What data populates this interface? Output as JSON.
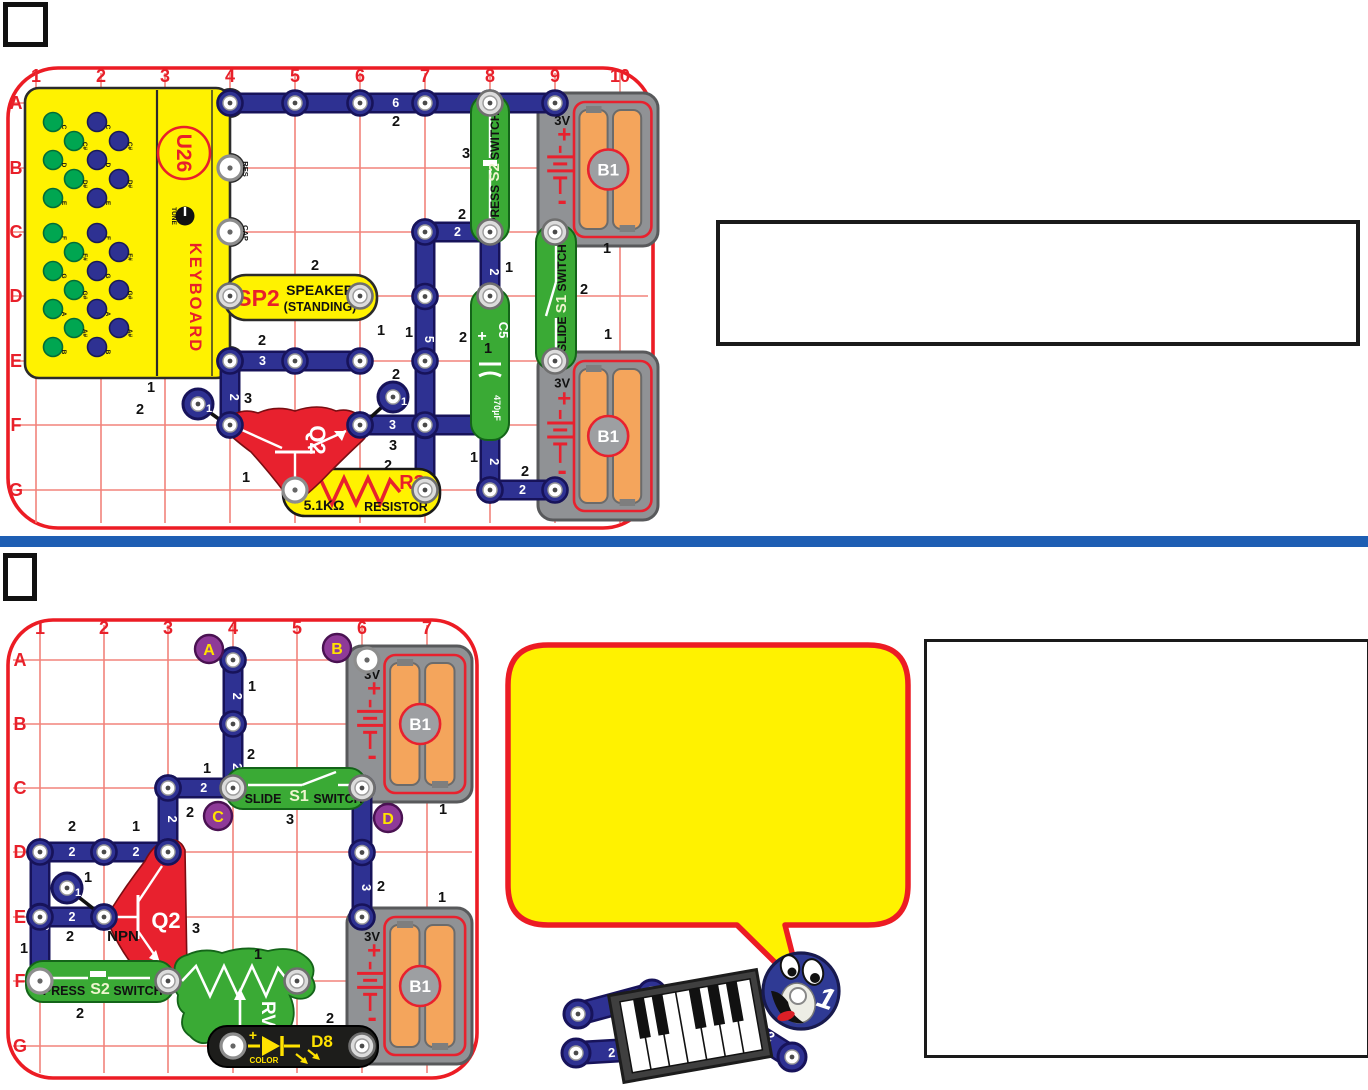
{
  "colors": {
    "board_border": "#EC1C24",
    "grid": "#F2837B",
    "grid_label": "#E8202A",
    "wire": "#2E3192",
    "wire_dark": "#17135A",
    "green": "#3AAA35",
    "green_dark": "#146419",
    "yellow": "#FFF200",
    "part_red": "#E8212E",
    "part_red_dark": "#7A0D12",
    "black_part": "#1D1D1B",
    "battery_gray": "#909295",
    "battery_edge": "#58595B",
    "cell_orange": "#F4A55C",
    "purple": "#8E3A98",
    "divider_blue": "#1E5EB3",
    "marker_text": "#FFE200",
    "pale": "#EFF5CF",
    "sym_white": "#FFFFFF",
    "label_black": "#111111"
  },
  "squares": [
    {
      "x": 3,
      "y": 2,
      "w": 45,
      "h": 45
    },
    {
      "x": 3,
      "y": 553,
      "w": 34,
      "h": 48
    }
  ],
  "text_boxes": [
    {
      "x": 716,
      "y": 220,
      "w": 636,
      "h": 118
    },
    {
      "x": 924,
      "y": 639,
      "w": 440,
      "h": 413
    }
  ],
  "divider": {
    "y": 536,
    "h": 11
  },
  "project1": {
    "board": {
      "x": 8,
      "y": 68,
      "w": 645,
      "h": 460,
      "r": 50,
      "col_labels": [
        "1",
        "2",
        "3",
        "4",
        "5",
        "6",
        "7",
        "8",
        "9",
        "10"
      ],
      "col_x": [
        36,
        101,
        165,
        230,
        295,
        360,
        425,
        490,
        555,
        620
      ],
      "row_labels": [
        "A",
        "B",
        "C",
        "D",
        "E",
        "F",
        "G"
      ],
      "row_y": [
        103,
        168,
        232,
        296,
        361,
        425,
        490
      ],
      "col_label_y": 82,
      "row_label_x": 16
    },
    "batteries": [
      {
        "x": 538,
        "y": 93,
        "w": 120,
        "h": 153,
        "code": "B1",
        "volts": "3V",
        "plus": "+",
        "minus": "-"
      },
      {
        "x": 538,
        "y": 352,
        "w": 120,
        "h": 168,
        "code": "B1",
        "volts": "3V",
        "plus": "+",
        "minus": "-"
      }
    ],
    "wires": [
      {
        "c1": 4,
        "r1": 0,
        "c2": 9,
        "r2": 0,
        "n": "6",
        "t": 0.51
      },
      {
        "c1": 7,
        "r1": 2,
        "c2": 8,
        "r2": 2,
        "n": "2",
        "t": 0.5
      },
      {
        "c1": 8,
        "r1": 2,
        "c2": 8,
        "r2": 3,
        "n": "2",
        "t": 0.56
      },
      {
        "c1": 7,
        "r1": 2,
        "c2": 7,
        "r2": 6,
        "n": "5",
        "t": 0.4
      },
      {
        "c1": 4,
        "r1": 4,
        "c2": 6,
        "r2": 4,
        "n": "3",
        "t": 0.25
      },
      {
        "c1": 4,
        "r1": 4,
        "c2": 4,
        "r2": 5,
        "n": "2",
        "t": 0.5
      },
      {
        "c1": 6,
        "r1": 5,
        "c2": 8,
        "r2": 5,
        "n": "3",
        "t": 0.25
      },
      {
        "c1": 8,
        "r1": 5,
        "c2": 8,
        "r2": 6,
        "n": "2",
        "t": 0.5
      },
      {
        "c1": 8,
        "r1": 6,
        "c2": 9,
        "r2": 6,
        "n": "2",
        "t": 0.5
      }
    ],
    "jumpers": [
      {
        "x": 198,
        "y": 404,
        "lx": 230,
        "ly": 427,
        "n": "1"
      },
      {
        "x": 393,
        "y": 397,
        "lx": 360,
        "ly": 427,
        "n": "1"
      }
    ],
    "levels": [
      [
        396,
        126,
        "2"
      ],
      [
        462,
        219,
        "2"
      ],
      [
        509,
        272,
        "1"
      ],
      [
        466,
        158,
        "3"
      ],
      [
        607,
        253,
        "1"
      ],
      [
        584,
        294,
        "2"
      ],
      [
        608,
        339,
        "1"
      ],
      [
        463,
        342,
        "2"
      ],
      [
        381,
        335,
        "1"
      ],
      [
        409,
        337,
        "1"
      ],
      [
        262,
        345,
        "2"
      ],
      [
        315,
        270,
        "2"
      ],
      [
        248,
        403,
        "3"
      ],
      [
        140,
        414,
        "2"
      ],
      [
        151,
        392,
        "1"
      ],
      [
        396,
        379,
        "2"
      ],
      [
        393,
        450,
        "3"
      ],
      [
        488,
        353,
        "1"
      ],
      [
        474,
        462,
        "1"
      ],
      [
        525,
        476,
        "2"
      ],
      [
        246,
        482,
        "1"
      ],
      [
        388,
        470,
        "2"
      ]
    ],
    "keyboard": {
      "x": 25,
      "y": 88,
      "w": 205,
      "h": 290,
      "code": "U26",
      "name": "KEYBOARD",
      "tune": "TUNE",
      "res": "RES",
      "cap": "CAP",
      "notes": [
        "C",
        "C#",
        "D",
        "D#",
        "E",
        "F",
        "F#",
        "G",
        "G#",
        "A",
        "A#",
        "B"
      ]
    },
    "sp2": {
      "code": "SP2",
      "line1": "SPEAKER",
      "line2": "(STANDING)"
    },
    "s2": {
      "w1": "PRESS",
      "code": "S2",
      "w2": "SWITCH"
    },
    "s1": {
      "w1": "SLIDE",
      "code": "S1",
      "w2": "SWITCH"
    },
    "c5": {
      "code": "C5",
      "plus": "+",
      "value": "470µF"
    },
    "q2": {
      "code": "Q2"
    },
    "r3": {
      "code": "R3",
      "value": "5.1KΩ",
      "word": "RESISTOR"
    }
  },
  "project2": {
    "board": {
      "x": 8,
      "y": 620,
      "w": 469,
      "h": 458,
      "r": 45,
      "col_labels": [
        "1",
        "2",
        "3",
        "4",
        "5",
        "6",
        "7"
      ],
      "col_x": [
        40,
        104,
        168,
        233,
        297,
        362,
        427
      ],
      "row_labels": [
        "A",
        "B",
        "C",
        "D",
        "E",
        "F",
        "G"
      ],
      "row_y": [
        660,
        724,
        788,
        852,
        917,
        981,
        1046
      ],
      "col_label_y": 634,
      "row_label_x": 20
    },
    "batteries": [
      {
        "x": 347,
        "y": 646,
        "w": 125,
        "h": 156,
        "code": "B1",
        "volts": "3V",
        "plus": "+",
        "minus": "-"
      },
      {
        "x": 347,
        "y": 908,
        "w": 125,
        "h": 156,
        "code": "B1",
        "volts": "3V",
        "plus": "+",
        "minus": "-"
      }
    ],
    "wires": [
      {
        "c1": 4,
        "r1": 0,
        "c2": 4,
        "r2": 1,
        "n": "2",
        "t": 0.5
      },
      {
        "c1": 4,
        "r1": 1,
        "c2": 4,
        "r2": 2,
        "n": "2",
        "t": 0.6
      },
      {
        "c1": 3,
        "r1": 2,
        "c2": 4,
        "r2": 2,
        "n": "2",
        "t": 0.55
      },
      {
        "c1": 3,
        "r1": 2,
        "c2": 3,
        "r2": 3,
        "n": "2",
        "t": 0.42
      },
      {
        "c1": 1,
        "r1": 3,
        "c2": 2,
        "r2": 3,
        "n": "2",
        "t": 0.5
      },
      {
        "c1": 2,
        "r1": 3,
        "c2": 3,
        "r2": 3,
        "n": "2",
        "t": 0.5
      },
      {
        "c1": 1,
        "r1": 3,
        "c2": 1,
        "r2": 5,
        "n": "3",
        "t": 0.55
      },
      {
        "c1": 1,
        "r1": 4,
        "c2": 2,
        "r2": 4,
        "n": "2",
        "t": 0.5
      },
      {
        "c1": 6,
        "r1": 2,
        "c2": 6,
        "r2": 4,
        "n": "3",
        "t": 0.74
      }
    ],
    "jumpers": [
      {
        "x": 67,
        "y": 888,
        "lx": 104,
        "ly": 917,
        "n": "1"
      }
    ],
    "levels": [
      [
        252,
        691,
        "1"
      ],
      [
        251,
        759,
        "2"
      ],
      [
        207,
        773,
        "1"
      ],
      [
        190,
        817,
        "2"
      ],
      [
        72,
        831,
        "2"
      ],
      [
        136,
        831,
        "1"
      ],
      [
        24,
        953,
        "1"
      ],
      [
        70,
        941,
        "2"
      ],
      [
        88,
        882,
        "1"
      ],
      [
        381,
        891,
        "2"
      ],
      [
        290,
        824,
        "3"
      ],
      [
        443,
        814,
        "1"
      ],
      [
        442,
        902,
        "1"
      ],
      [
        196,
        933,
        "3"
      ],
      [
        80,
        1018,
        "2"
      ],
      [
        258,
        959,
        "1"
      ],
      [
        330,
        1023,
        "2"
      ]
    ],
    "markers": [
      {
        "x": 209,
        "y": 649,
        "ch": "A"
      },
      {
        "x": 337,
        "y": 648,
        "ch": "B"
      },
      {
        "x": 218,
        "y": 816,
        "ch": "C"
      },
      {
        "x": 388,
        "y": 818,
        "ch": "D"
      }
    ],
    "s1": {
      "w1": "SLIDE",
      "code": "S1",
      "w2": "SWITCH"
    },
    "s2": {
      "w1": "PRESS",
      "code": "S2",
      "w2": "SWITCH"
    },
    "q2": {
      "code": "Q2",
      "type": "NPN"
    },
    "rv": {
      "code": "RV"
    },
    "d8": {
      "code": "D8",
      "plus": "+",
      "word": "COLOR"
    }
  },
  "bubble": {
    "x": 508,
    "y": 645,
    "w": 400,
    "h": 280,
    "tail": [
      [
        785,
        925
      ],
      [
        801,
        988
      ],
      [
        737,
        925
      ]
    ]
  },
  "mascot": {
    "head_label": "1",
    "limb_label": "2"
  }
}
